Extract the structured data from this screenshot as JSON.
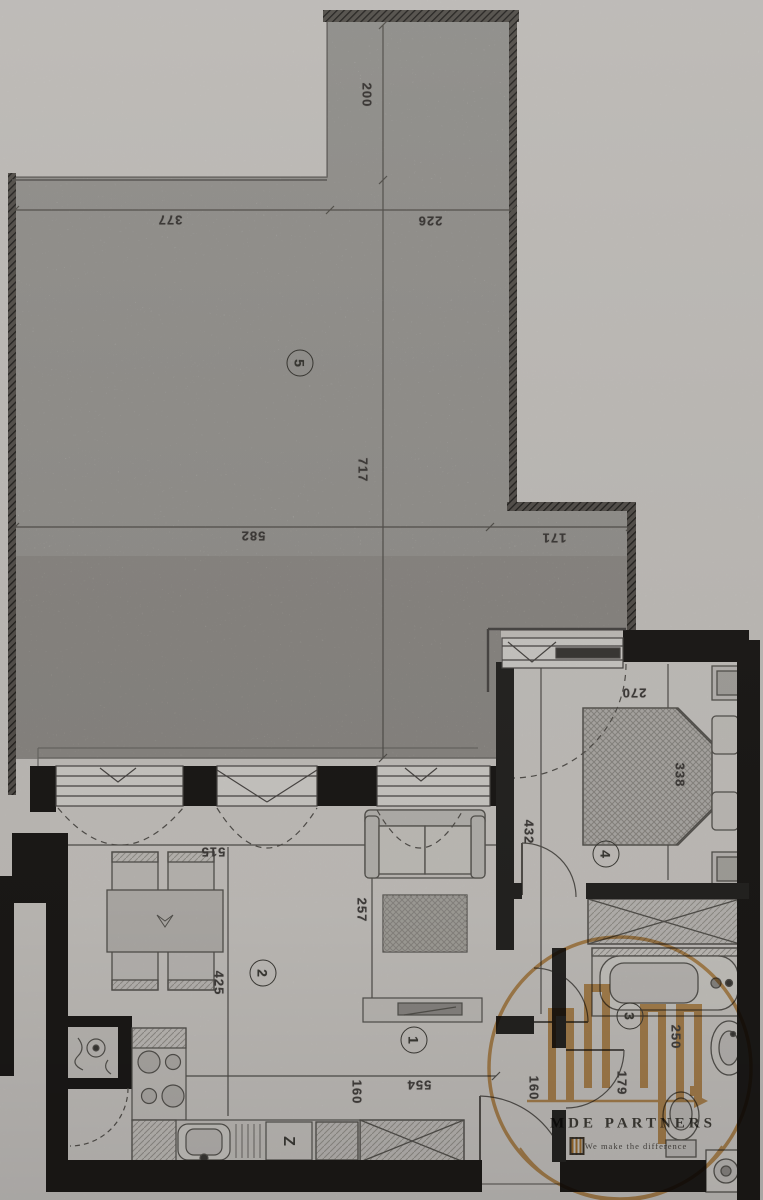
{
  "plan": {
    "rooms": {
      "r1": "1",
      "r2": "2",
      "r3": "3",
      "r4": "4",
      "r5": "5"
    },
    "dims": {
      "terrace_depth_top": "200",
      "terrace_width_left": "377",
      "terrace_width_mid": "226",
      "terrace_height": "717",
      "terrace_width_lower": "582",
      "terrace_step": "171",
      "bedroom_window": "270",
      "bedroom_length": "338",
      "bedroom_side": "432",
      "living_width": "515",
      "living_length": "425",
      "room1_length": "257",
      "bottom_width": "554",
      "kitchen_gap": "160",
      "hall_width": "160",
      "bath_width": "250",
      "bath_length": "179"
    },
    "kitchen": {
      "dishwasher_label": "Z"
    },
    "icons": [
      "terrace",
      "window",
      "balcony-door",
      "dining-table",
      "chair",
      "sofa",
      "rug",
      "tv-bench",
      "bed",
      "pillow",
      "nightstand",
      "wardrobe",
      "bathtub",
      "washbasin",
      "toilet",
      "washing-machine",
      "stove",
      "kitchen-sink",
      "dishwasher",
      "utility-shaft",
      "door-swing"
    ]
  },
  "watermark": {
    "brand": "MDE PARTNERS",
    "tagline": "We make the difference",
    "accent_color": "#cf8a2f"
  }
}
